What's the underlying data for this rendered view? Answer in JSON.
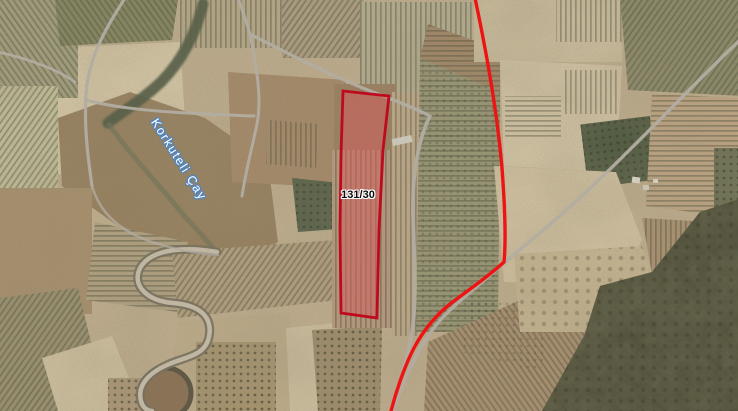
{
  "map": {
    "parcel": {
      "label": "131/30",
      "outline_color": "#bf0a1e",
      "fill_color": "rgba(214,92,92,0.5)"
    },
    "route": {
      "color": "#ee1414"
    },
    "river": {
      "label": "Korkuteli Çay",
      "text_color": "#ffffff",
      "halo_color": "#4f86c6"
    },
    "roads_color": "#b8b2a8"
  }
}
